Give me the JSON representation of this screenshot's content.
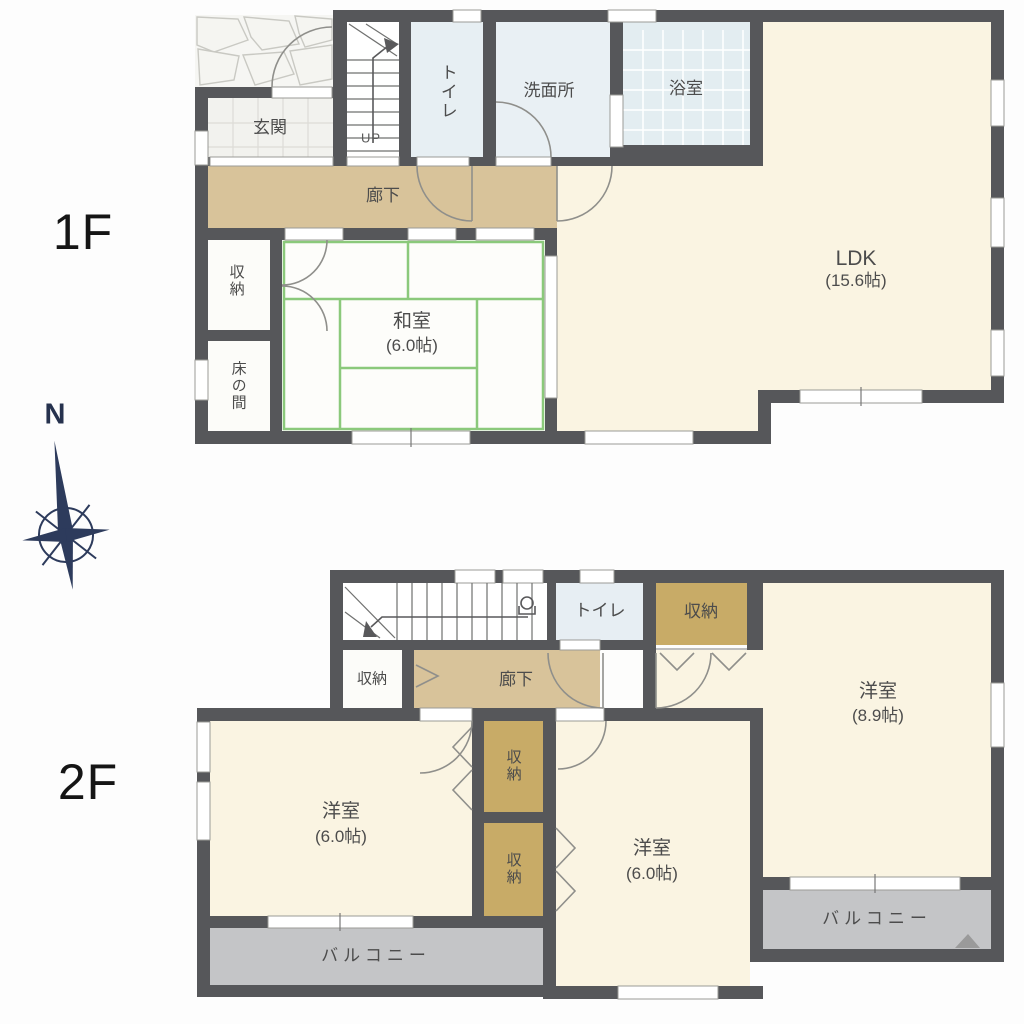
{
  "title": "2-story house floor plan",
  "compass": {
    "north_label": "N",
    "color": "#2d3b5c"
  },
  "floor1": {
    "label": "1F",
    "rooms": {
      "genkan": "玄関",
      "toilet": "トイレ",
      "washroom": "洗面所",
      "bathroom": "浴室",
      "ldk_name": "LDK",
      "ldk_size": "(15.6帖)",
      "hallway": "廊下",
      "storage": "収納",
      "tokonoma": "床の間",
      "washitsu_name": "和室",
      "washitsu_size": "(6.0帖)",
      "stairs_up": "UP"
    }
  },
  "floor2": {
    "label": "2F",
    "rooms": {
      "toilet": "トイレ",
      "storage_top": "収納",
      "storage_left": "収納",
      "hallway": "廊下",
      "west_room_name": "洋室",
      "west_room_size": "(6.0帖)",
      "middle_room_name": "洋室",
      "middle_room_size": "(6.0帖)",
      "east_room_name": "洋室",
      "east_room_size": "(8.9帖)",
      "closet_upper": "収納",
      "closet_lower": "収納",
      "balcony_west": "バルコニー",
      "balcony_east": "バルコニー"
    }
  },
  "colors": {
    "wall": "#56575a",
    "room_cream": "#faf4e2",
    "hallway_tan": "#d8c39a",
    "closet_tan": "#c8ab67",
    "wet_area_blue": "#e8eff3",
    "balcony_gray": "#c4c5c7",
    "tatami_green": "#8bc97b",
    "compass_navy": "#2d3b5c"
  }
}
